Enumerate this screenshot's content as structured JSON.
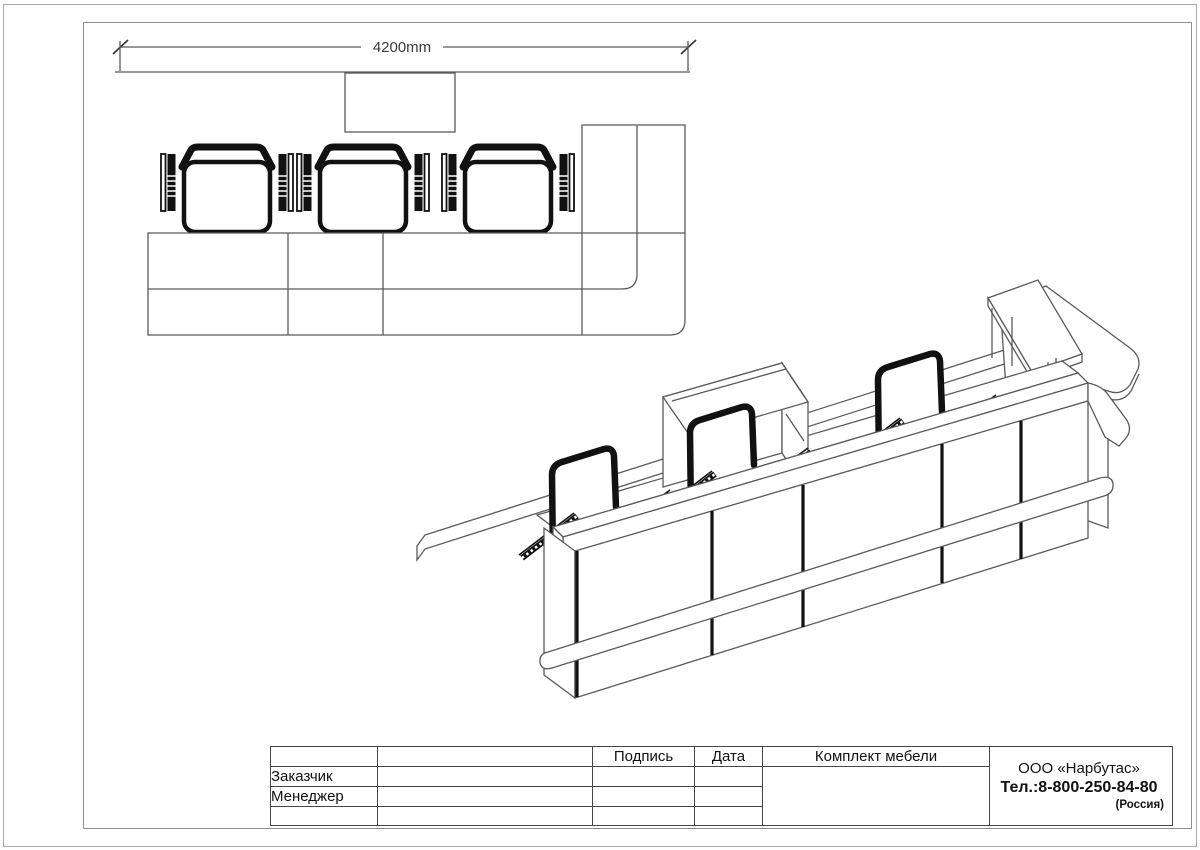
{
  "plan_view": {
    "dimension_label": "4200mm",
    "workplaces": 3
  },
  "isometric_view": {
    "workplaces": 3
  },
  "title_block": {
    "signature_header": "Подпись",
    "date_header": "Дата",
    "set_header": "Комплект мебели",
    "customer_label": "Заказчик",
    "manager_label": "Менеджер",
    "company": {
      "name": "ООО «Нарбутас»",
      "phone": "Тел.:8-800-250-84-80",
      "country": "(Россия)"
    }
  },
  "colors": {
    "background": "#ffffff",
    "frame": "#8f8f8f",
    "line": "#5a5a5a",
    "chair_black": "#111111"
  }
}
